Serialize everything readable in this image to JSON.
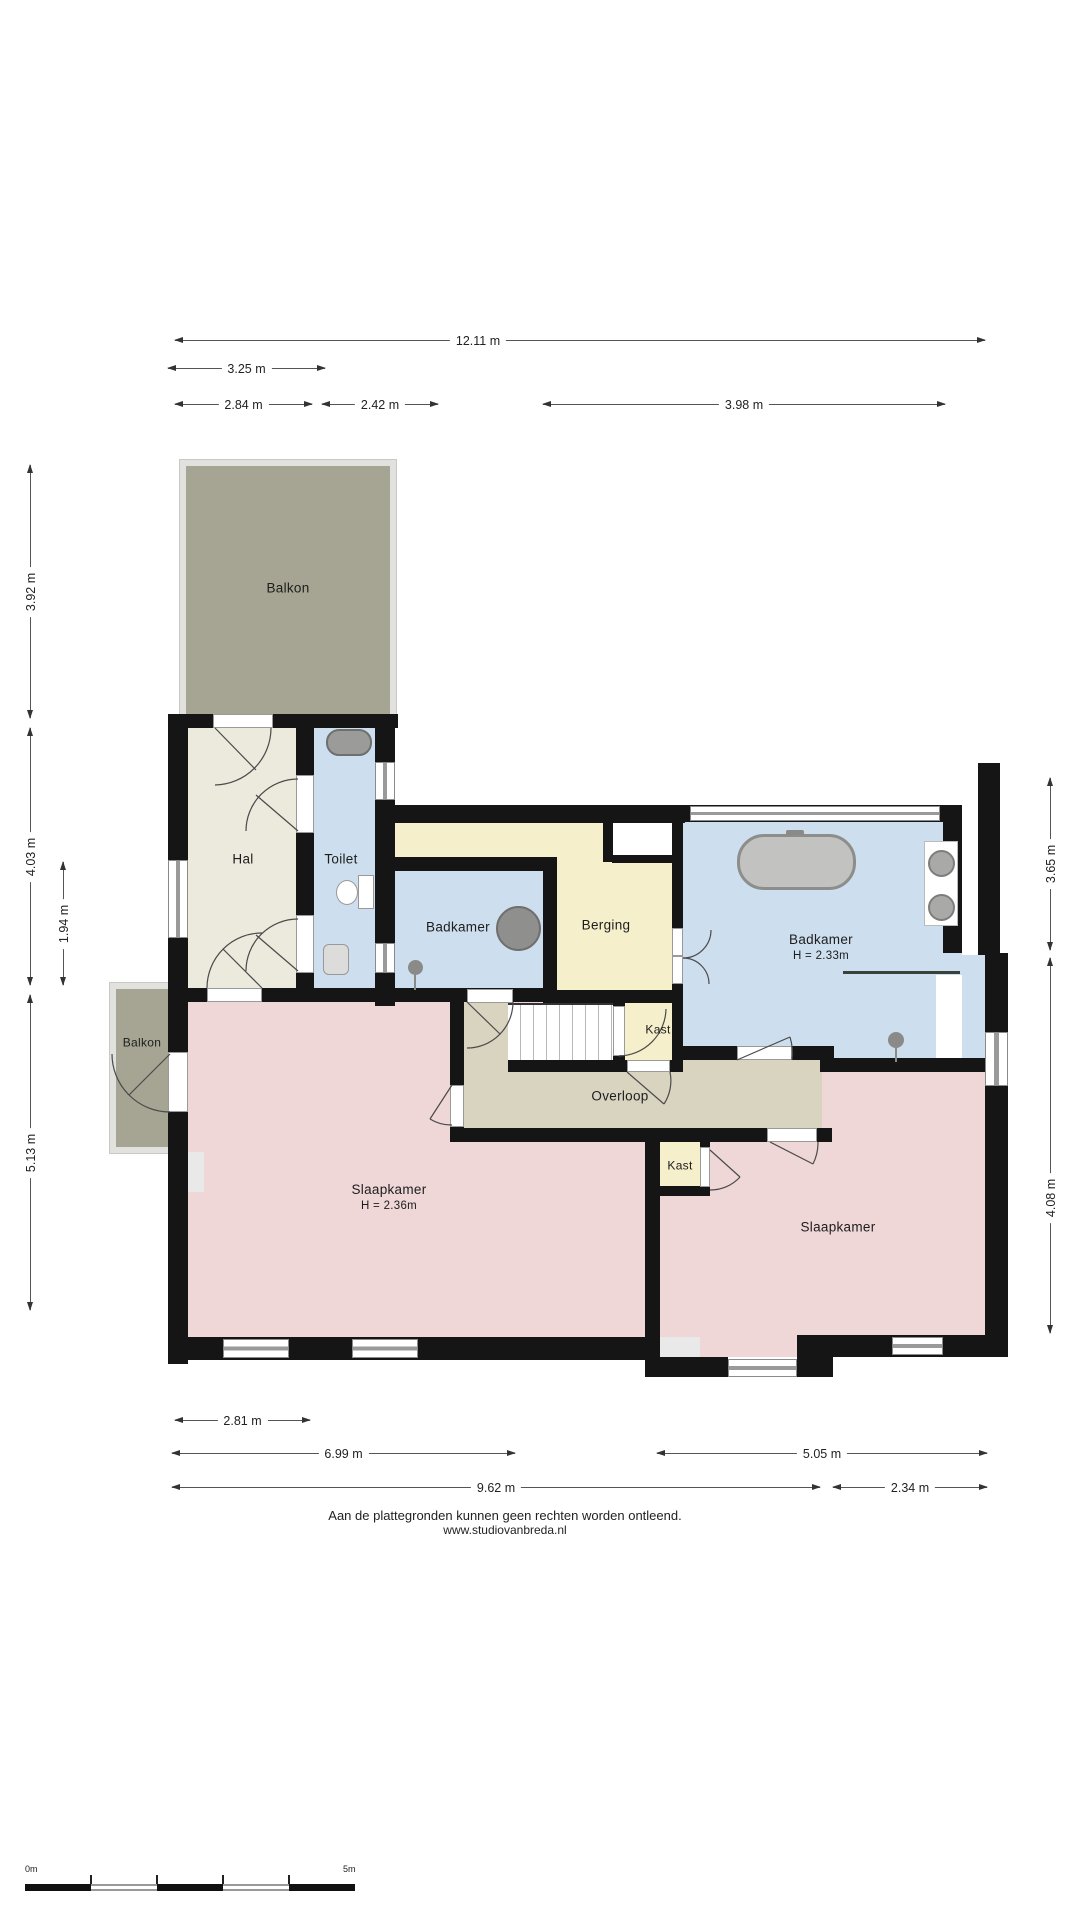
{
  "rooms": {
    "balkon_top": {
      "label": "Balkon"
    },
    "hal": {
      "label": "Hal"
    },
    "toilet": {
      "label": "Toilet"
    },
    "badkamer_klein": {
      "label": "Badkamer"
    },
    "berging": {
      "label": "Berging"
    },
    "badkamer_groot": {
      "label": "Badkamer",
      "height_note": "H = 2.33m"
    },
    "kast_boven": {
      "label": "Kast"
    },
    "overloop": {
      "label": "Overloop"
    },
    "balkon_links": {
      "label": "Balkon"
    },
    "slaapkamer_links": {
      "label": "Slaapkamer",
      "height_note": "H = 2.36m"
    },
    "kast_onder": {
      "label": "Kast"
    },
    "slaapkamer_rechts": {
      "label": "Slaapkamer"
    }
  },
  "dimensions": {
    "top": [
      "12.11 m",
      "3.25 m",
      "2.84 m",
      "2.42 m",
      "3.98 m"
    ],
    "left": [
      "3.92 m",
      "4.03 m",
      "1.94 m",
      "5.13 m"
    ],
    "right": [
      "3.65 m",
      "4.08 m"
    ],
    "bottom": [
      "2.81 m",
      "6.99 m",
      "5.05 m",
      "9.62 m",
      "2.34 m"
    ]
  },
  "footer": {
    "disclaimer": "Aan de plattegronden kunnen geen rechten worden ontleend.",
    "website": "www.studiovanbreda.nl"
  },
  "scale_bar": {
    "start": "0m",
    "end": "5m"
  },
  "colors": {
    "wall": "#151515",
    "balcony": "#a6a593",
    "hall_cream": "#ece9dd",
    "bathroom_blue": "#cddeee",
    "storage_yellow": "#f6efcc",
    "landing_tan": "#d8d4c0",
    "bedroom_pink": "#efd6d7"
  }
}
